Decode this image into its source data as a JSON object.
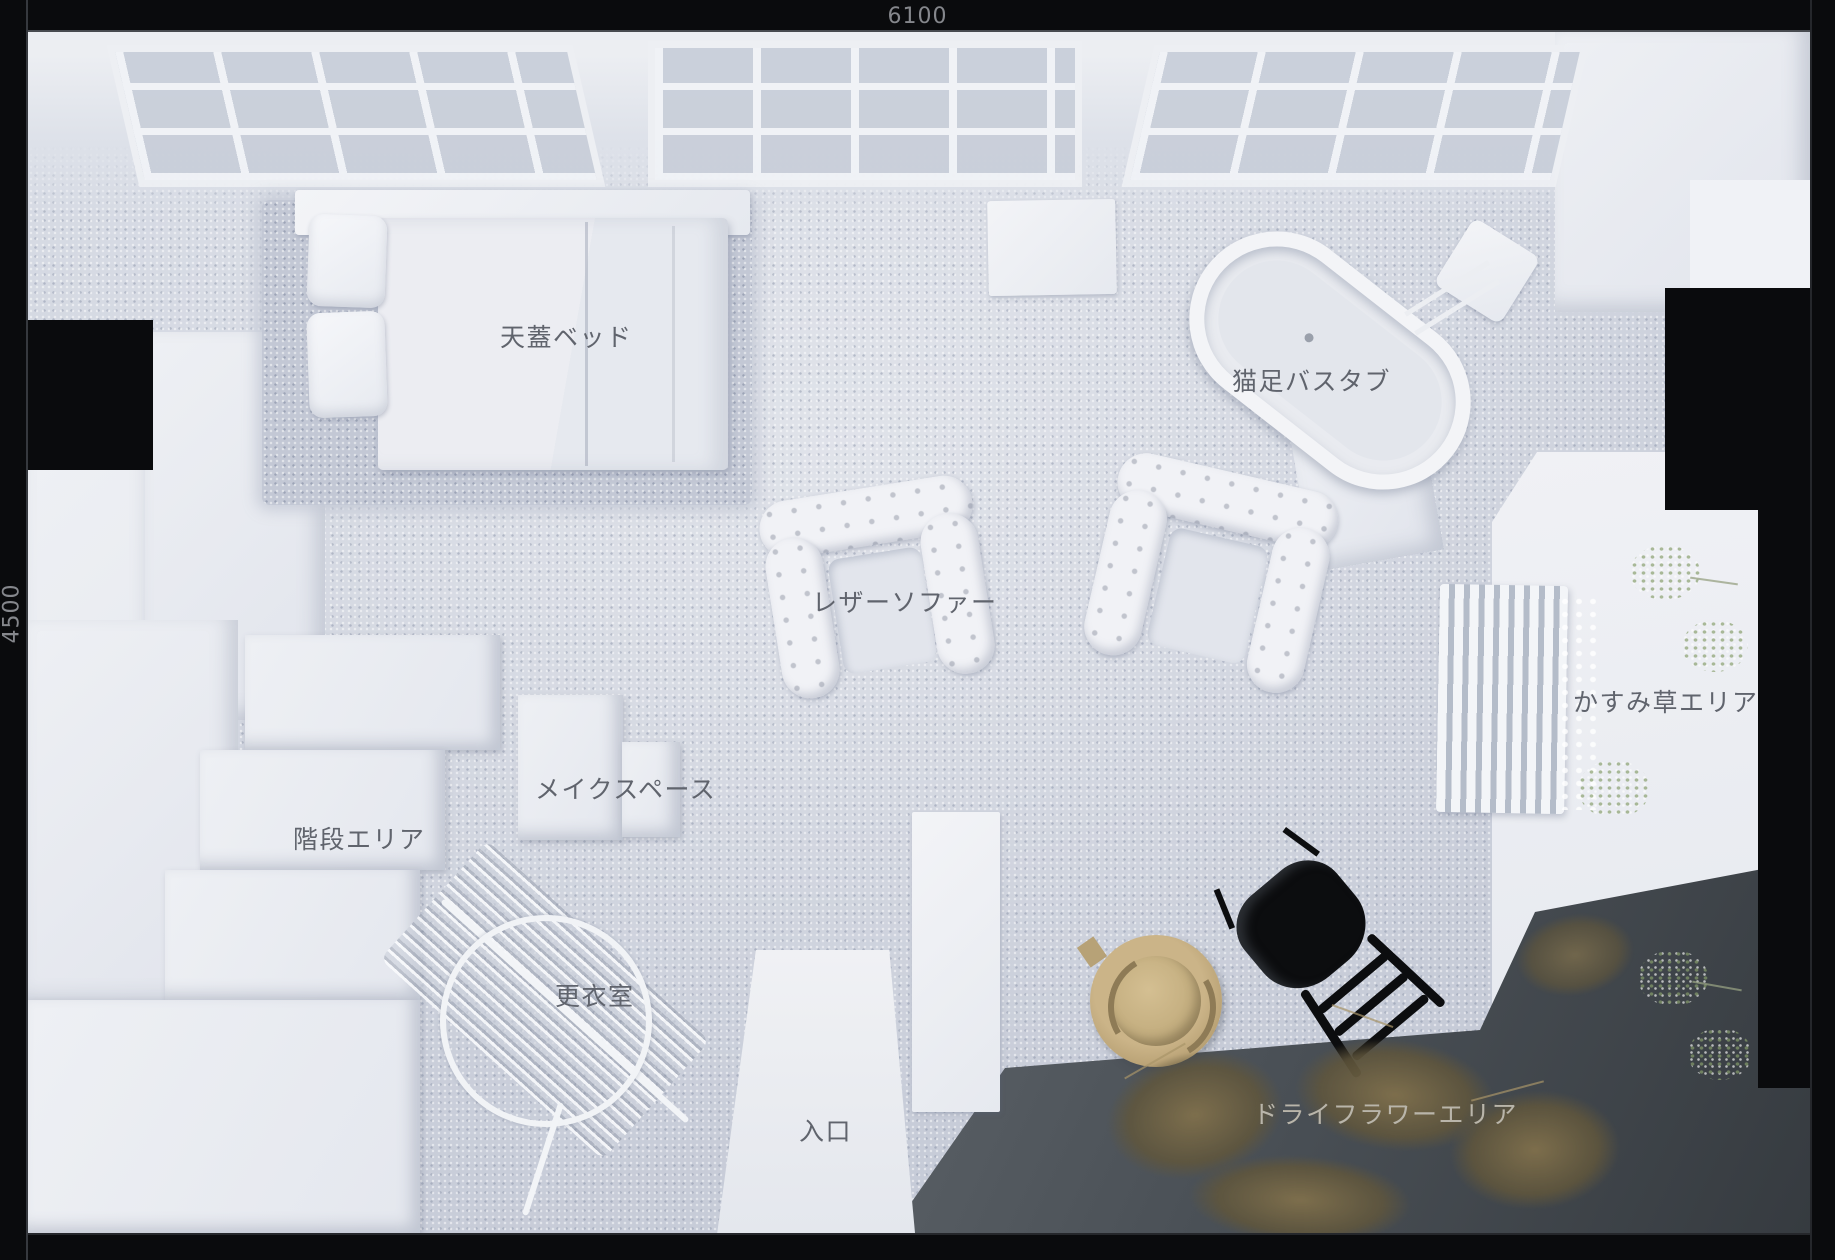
{
  "frame": {
    "width_label": "6100",
    "height_label": "4500"
  },
  "areas": {
    "canopy_bed": "天蓋ベッド",
    "clawfoot_bathtub": "猫足バスタブ",
    "leather_sofa": "レザーソファー",
    "babys_breath_area": "かすみ草エリア",
    "makeup_space": "メイクスペース",
    "stairs_area": "階段エリア",
    "changing_room": "更衣室",
    "entrance": "入口",
    "dried_flower_area": "ドライフラワーエリア"
  },
  "colors": {
    "frame_black": "#0a0b0d",
    "carpet_gray": "#ccd1db",
    "white_floor": "#edeff3",
    "concrete_dark": "#42474c",
    "label_gray": "#60646d",
    "label_light": "#b9b5aa",
    "dimension_label": "#85878c",
    "hat_tan": "#c0aa7c",
    "dried_flower_brown": "#6f6247",
    "plant_green": "#93a47e"
  }
}
